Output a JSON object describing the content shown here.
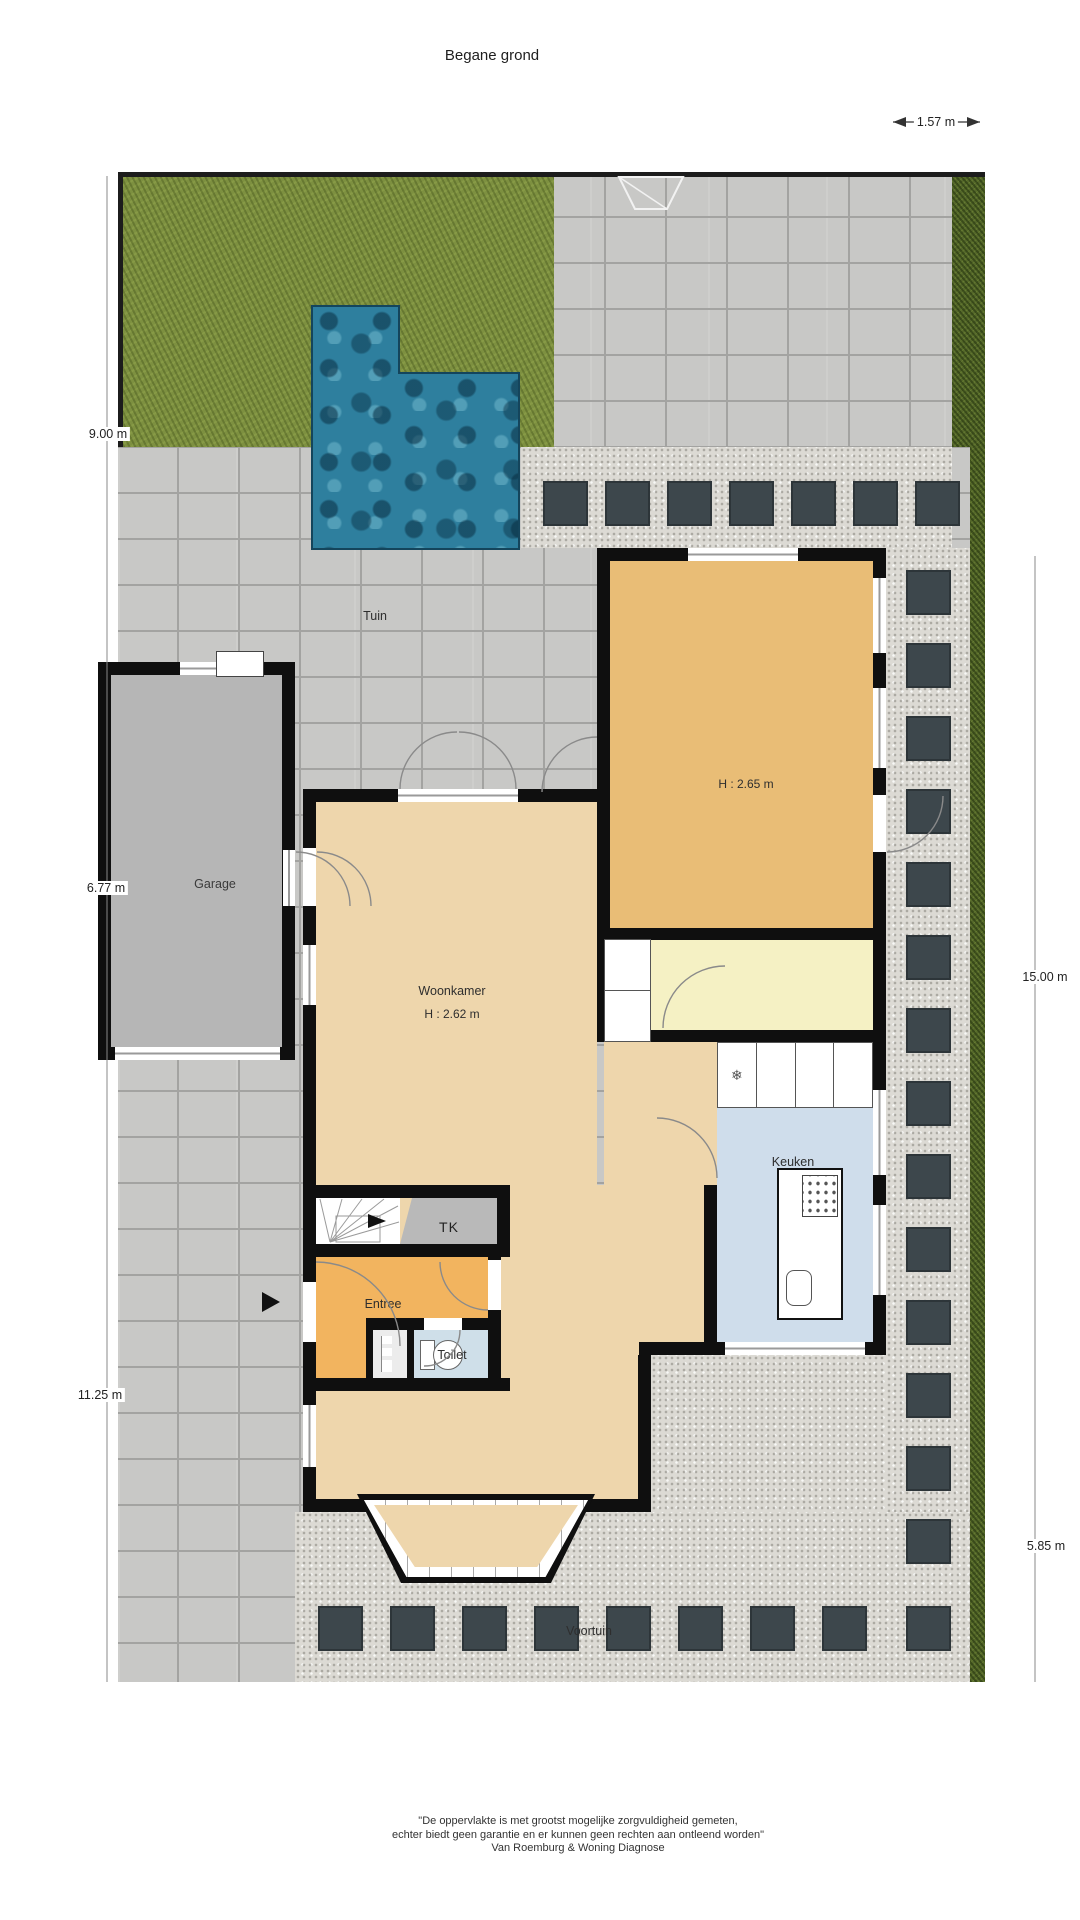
{
  "page": {
    "title": "Begane grond"
  },
  "dimensions": {
    "top": "1.57 m",
    "left": [
      "9.00 m",
      "6.77 m",
      "11.25 m"
    ],
    "right": [
      "15.00 m",
      "5.85 m"
    ]
  },
  "rooms": {
    "tuin": "Tuin",
    "garage": "Garage",
    "woonkamer": "Woonkamer",
    "woonkamer_ceiling": "H : 2.62 m",
    "upper_room_ceiling": "H : 2.65 m",
    "keuken": "Keuken",
    "tk": "TK",
    "entree": "Entree",
    "toilet": "Toilet",
    "voortuin": "Voortuin"
  },
  "footer": {
    "line1": "\"De oppervlakte is met grootst mogelijke zorgvuldigheid gemeten,",
    "line2": "echter biedt geen garantie en er kunnen geen rechten aan ontleend worden\"",
    "line3": "Van Roemburg & Woning Diagnose"
  },
  "colors": {
    "grass": "#7d9040",
    "hedge": "#55682a",
    "paving": "#c8c8c6",
    "paving-line": "#a3a3a1",
    "gravel": "#dcdad4",
    "pool": "#2e7f9e",
    "pool-edge": "#14455c",
    "wall": "#0f0f0f",
    "woonkamer": "#eed6ac",
    "upper-room": "#e9bd76",
    "entree": "#f2b45f",
    "utility": "#f5f1c4",
    "kitchen": "#cfddeb",
    "toilet": "#cfdfe9",
    "tk": "#b9b9b9",
    "garage-floor": "#b6b6b6",
    "stone": "#3d474c"
  }
}
